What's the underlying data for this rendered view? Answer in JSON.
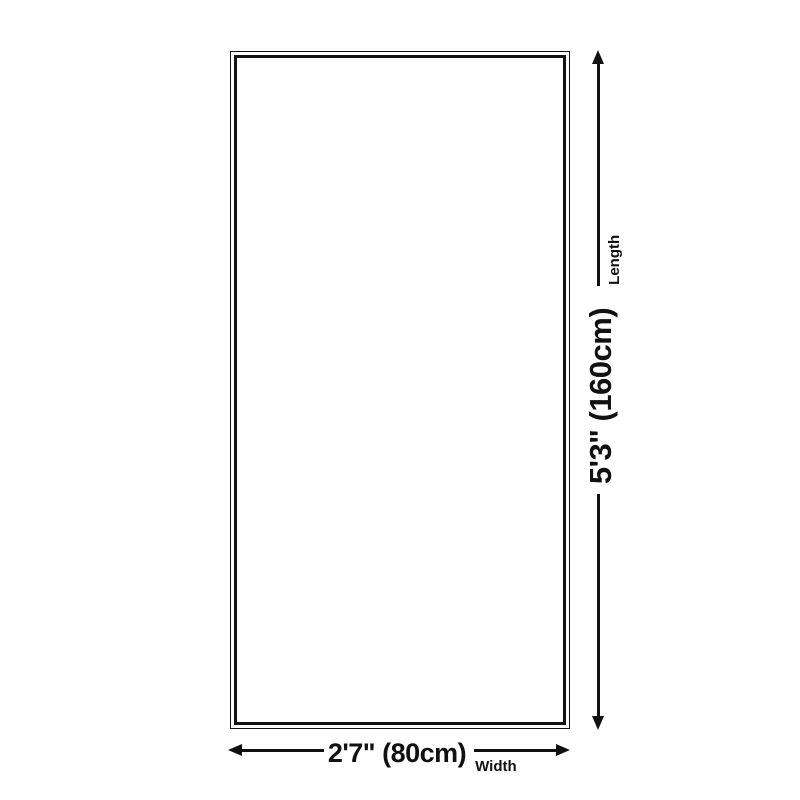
{
  "diagram": {
    "type": "product-dimension-diagram",
    "shape": "rectangle",
    "background_color": "#ffffff",
    "ink_color": "#111111",
    "dimensions": {
      "length": {
        "value": "5'3\" (160cm)",
        "label": "Length"
      },
      "width": {
        "value": "2'7\" (80cm)",
        "label": "Width"
      }
    }
  }
}
